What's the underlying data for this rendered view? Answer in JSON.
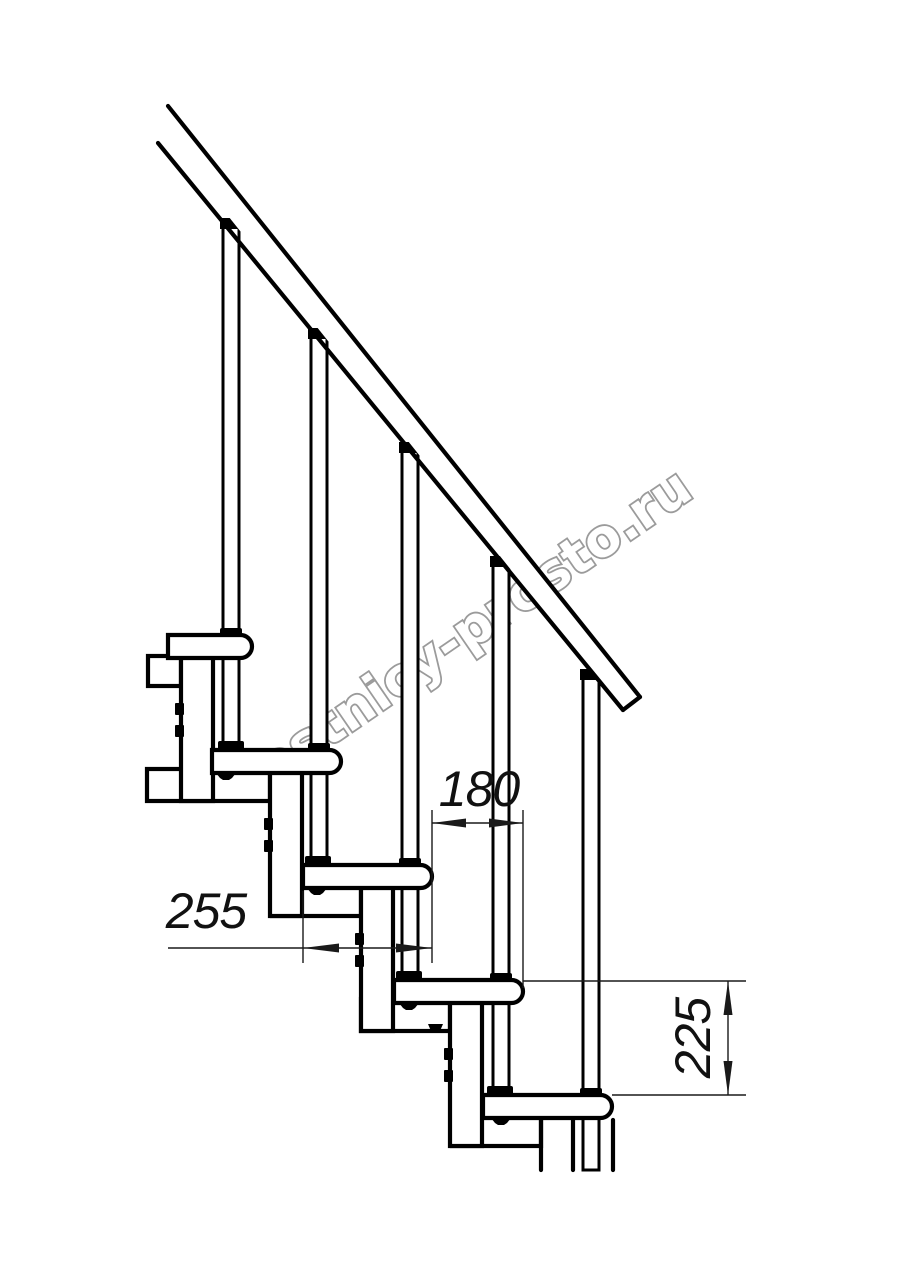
{
  "watermark": {
    "text": "lestnicy-prosto.ru",
    "color": "#9b9b9b"
  },
  "dimensions": {
    "tread_depth": "255",
    "step_run": "180",
    "riser_height": "225"
  },
  "drawing": {
    "line_color": "#000000",
    "dim_color": "#1a1a1a",
    "background": "#ffffff",
    "steps_visible": 5,
    "balusters_visible": 5
  }
}
